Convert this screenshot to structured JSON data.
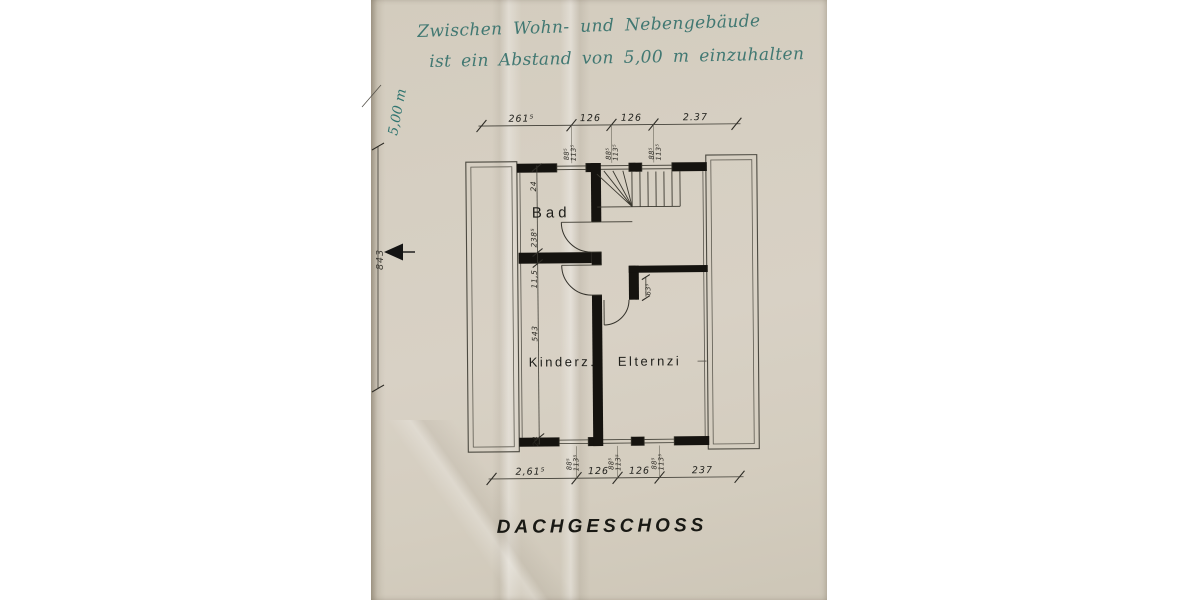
{
  "handwritten_note": {
    "line1": "Zwischen Wohn- und Nebengebäude",
    "line2": "ist ein Abstand von 5,00 m einzuhalten"
  },
  "margin": {
    "distance_label": "5,00 m",
    "height_dimension": "843"
  },
  "plan": {
    "title": "DACHGESCHOSS",
    "rooms": {
      "bathroom": "Bad",
      "children_room": "Kinderz.",
      "parents_room": "Elternzi"
    },
    "top_dimensions": {
      "d1": "261⁵",
      "d2": "126",
      "d3": "126",
      "d4": "2.37"
    },
    "bottom_dimensions": {
      "d1": "2,61⁵",
      "d2": "126",
      "d3": "126",
      "d4": "237"
    },
    "left_dimensions": {
      "d1": "24",
      "d2": "238⁵",
      "d3": "11,5",
      "d4": "543",
      "d5": "24"
    },
    "window_label": {
      "w": "88⁵",
      "h": "113⁵"
    },
    "niche_dimension": "63⁵"
  },
  "colors": {
    "paper": "#d6cfc2",
    "handwriting_ink": "#35716c",
    "drawing_ink": "#1a1813"
  }
}
